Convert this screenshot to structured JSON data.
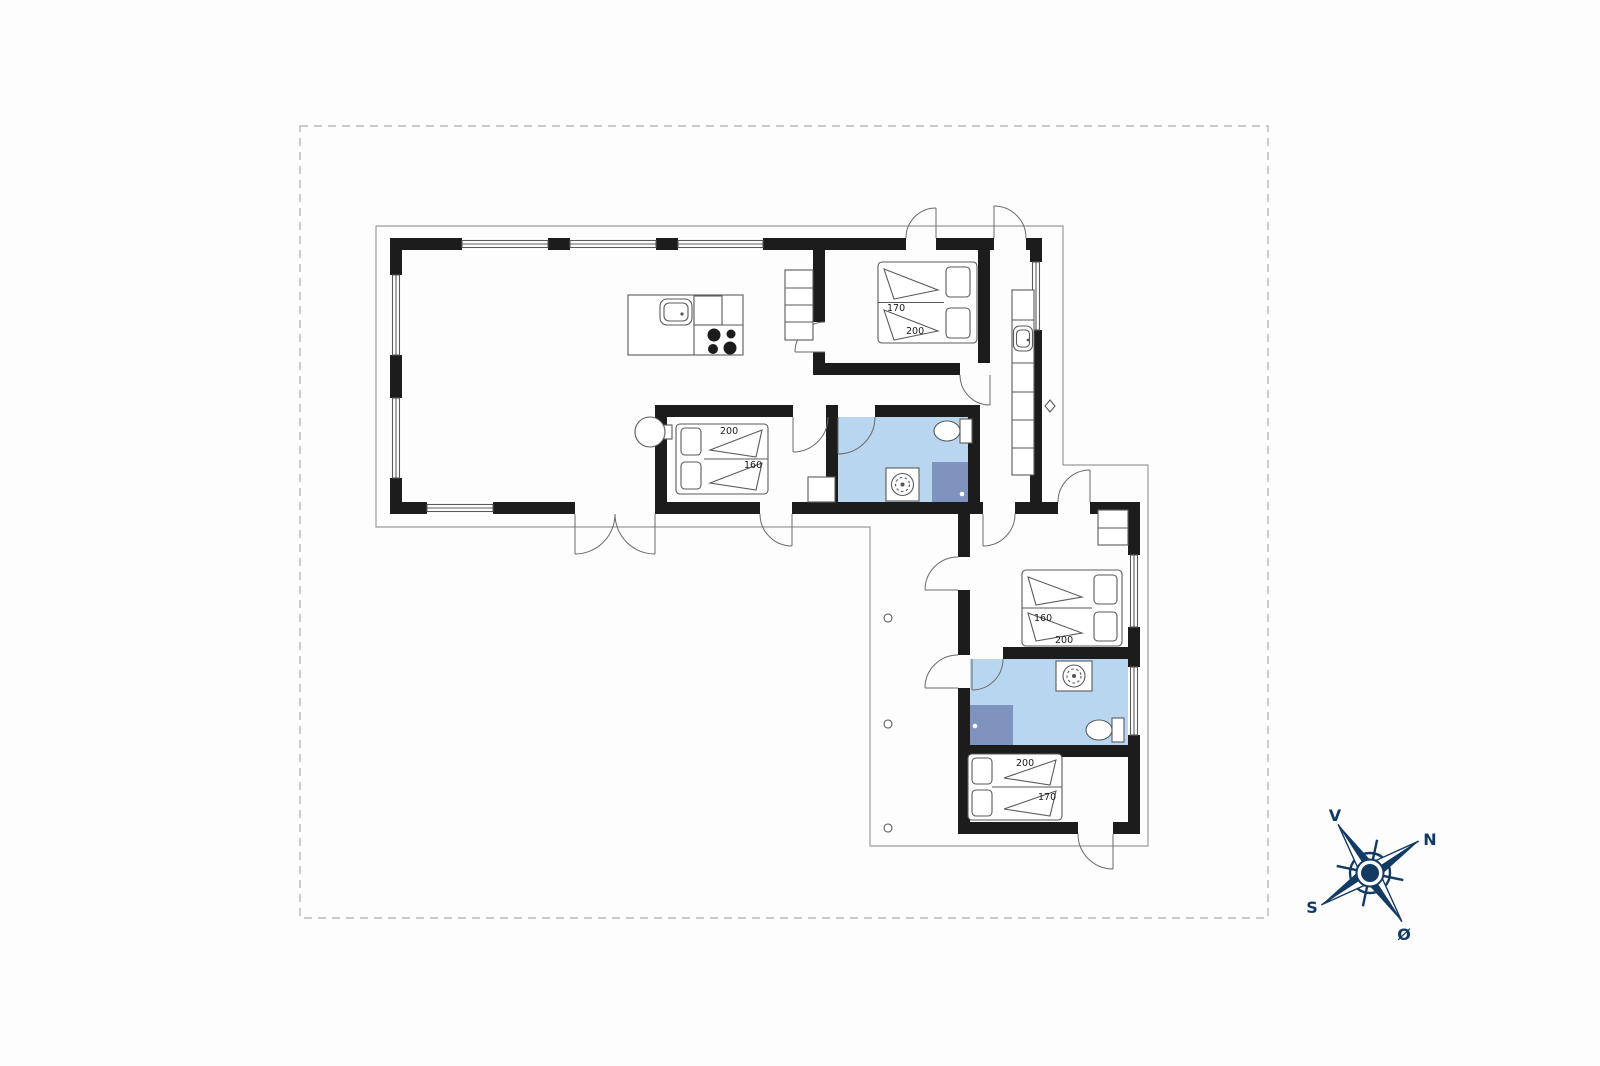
{
  "plan": {
    "beds": {
      "top_bedroom": {
        "width_label": "170",
        "length_label": "200"
      },
      "middle_bedroom": {
        "length_label": "200",
        "width_label": "160"
      },
      "annex_bedroom_1": {
        "width_label": "160",
        "length_label": "200"
      },
      "annex_bedroom_2": {
        "length_label": "200",
        "width_label": "170"
      }
    },
    "compass": {
      "west": "V",
      "north": "N",
      "south": "S",
      "east": "Ø"
    },
    "colors": {
      "wall": "#1c1c1c",
      "bathroom_floor": "#b9d6f0",
      "shower": "#7e93bd",
      "compass_navy": "#123a63",
      "outline_gray": "#9a9a9a",
      "boundary_dash": "#ababab"
    }
  }
}
